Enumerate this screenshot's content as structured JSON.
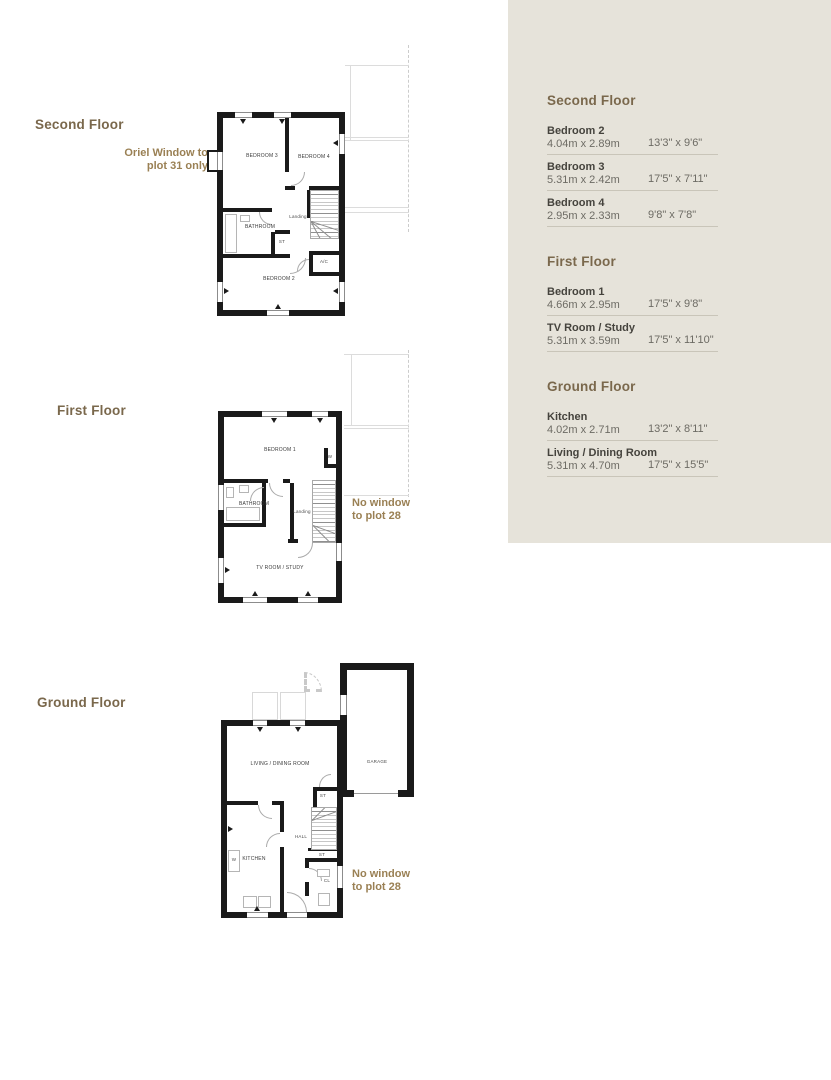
{
  "colors": {
    "panel_bg": "#e6e3da",
    "heading_brown": "#7a684c",
    "annotation_brown": "#9a8054",
    "wall_black": "#1a1a1a",
    "body_text": "#45433d",
    "dim_text": "#6d6b64",
    "divider": "#c9c5b9",
    "ghost_line": "#dcdcdc"
  },
  "floor_labels": {
    "second": "Second Floor",
    "first": "First Floor",
    "ground": "Ground Floor"
  },
  "annotations": {
    "oriel": [
      "Oriel Window to",
      "plot 31 only"
    ],
    "no_window_first": [
      "No window",
      "to plot 28"
    ],
    "no_window_ground": [
      "No window",
      "to plot 28"
    ],
    "ashp": [
      "ASHP",
      "pipework",
      "boxing to",
      "plot 28 only"
    ]
  },
  "plans": {
    "second": {
      "rooms": {
        "bedroom3": "BEDROOM 3",
        "bedroom4": "BEDROOM 4",
        "landing": "Landing",
        "bathroom": "BATHROOM",
        "store": "ST",
        "airing": "A/C",
        "bedroom2": "BEDROOM 2"
      }
    },
    "first": {
      "rooms": {
        "bedroom1": "BEDROOM 1",
        "wardrobe": "W",
        "bathroom": "BATHROOM",
        "landing": "Landing",
        "tv_room": "TV ROOM / STUDY"
      }
    },
    "ground": {
      "rooms": {
        "living": "LIVING / DINING ROOM",
        "kitchen": "KITCHEN",
        "washer": "W",
        "hall": "HALL",
        "store_top": "ST",
        "store_under_stairs": "ST",
        "cloakroom": "CL",
        "garage": "GARAGE"
      }
    }
  },
  "panel": {
    "sections": [
      {
        "heading": "Second Floor",
        "rows": [
          {
            "name": "Bedroom 2",
            "metric": "4.04m x 2.89m",
            "imperial": "13'3\" x 9'6\""
          },
          {
            "name": "Bedroom 3",
            "metric": "5.31m x 2.42m",
            "imperial": "17'5\" x 7'11\""
          },
          {
            "name": "Bedroom 4",
            "metric": "2.95m x 2.33m",
            "imperial": "9'8\" x 7'8\""
          }
        ]
      },
      {
        "heading": "First Floor",
        "rows": [
          {
            "name": "Bedroom 1",
            "metric": "4.66m x 2.95m",
            "imperial": "17'5\" x 9'8\""
          },
          {
            "name": "TV Room / Study",
            "metric": "5.31m x 3.59m",
            "imperial": "17'5\" x 11'10\""
          }
        ]
      },
      {
        "heading": "Ground Floor",
        "rows": [
          {
            "name": "Kitchen",
            "metric": "4.02m x 2.71m",
            "imperial": "13'2\" x 8'11\""
          },
          {
            "name": "Living / Dining Room",
            "metric": "5.31m x 4.70m",
            "imperial": "17'5\" x 15'5\""
          }
        ]
      }
    ]
  }
}
